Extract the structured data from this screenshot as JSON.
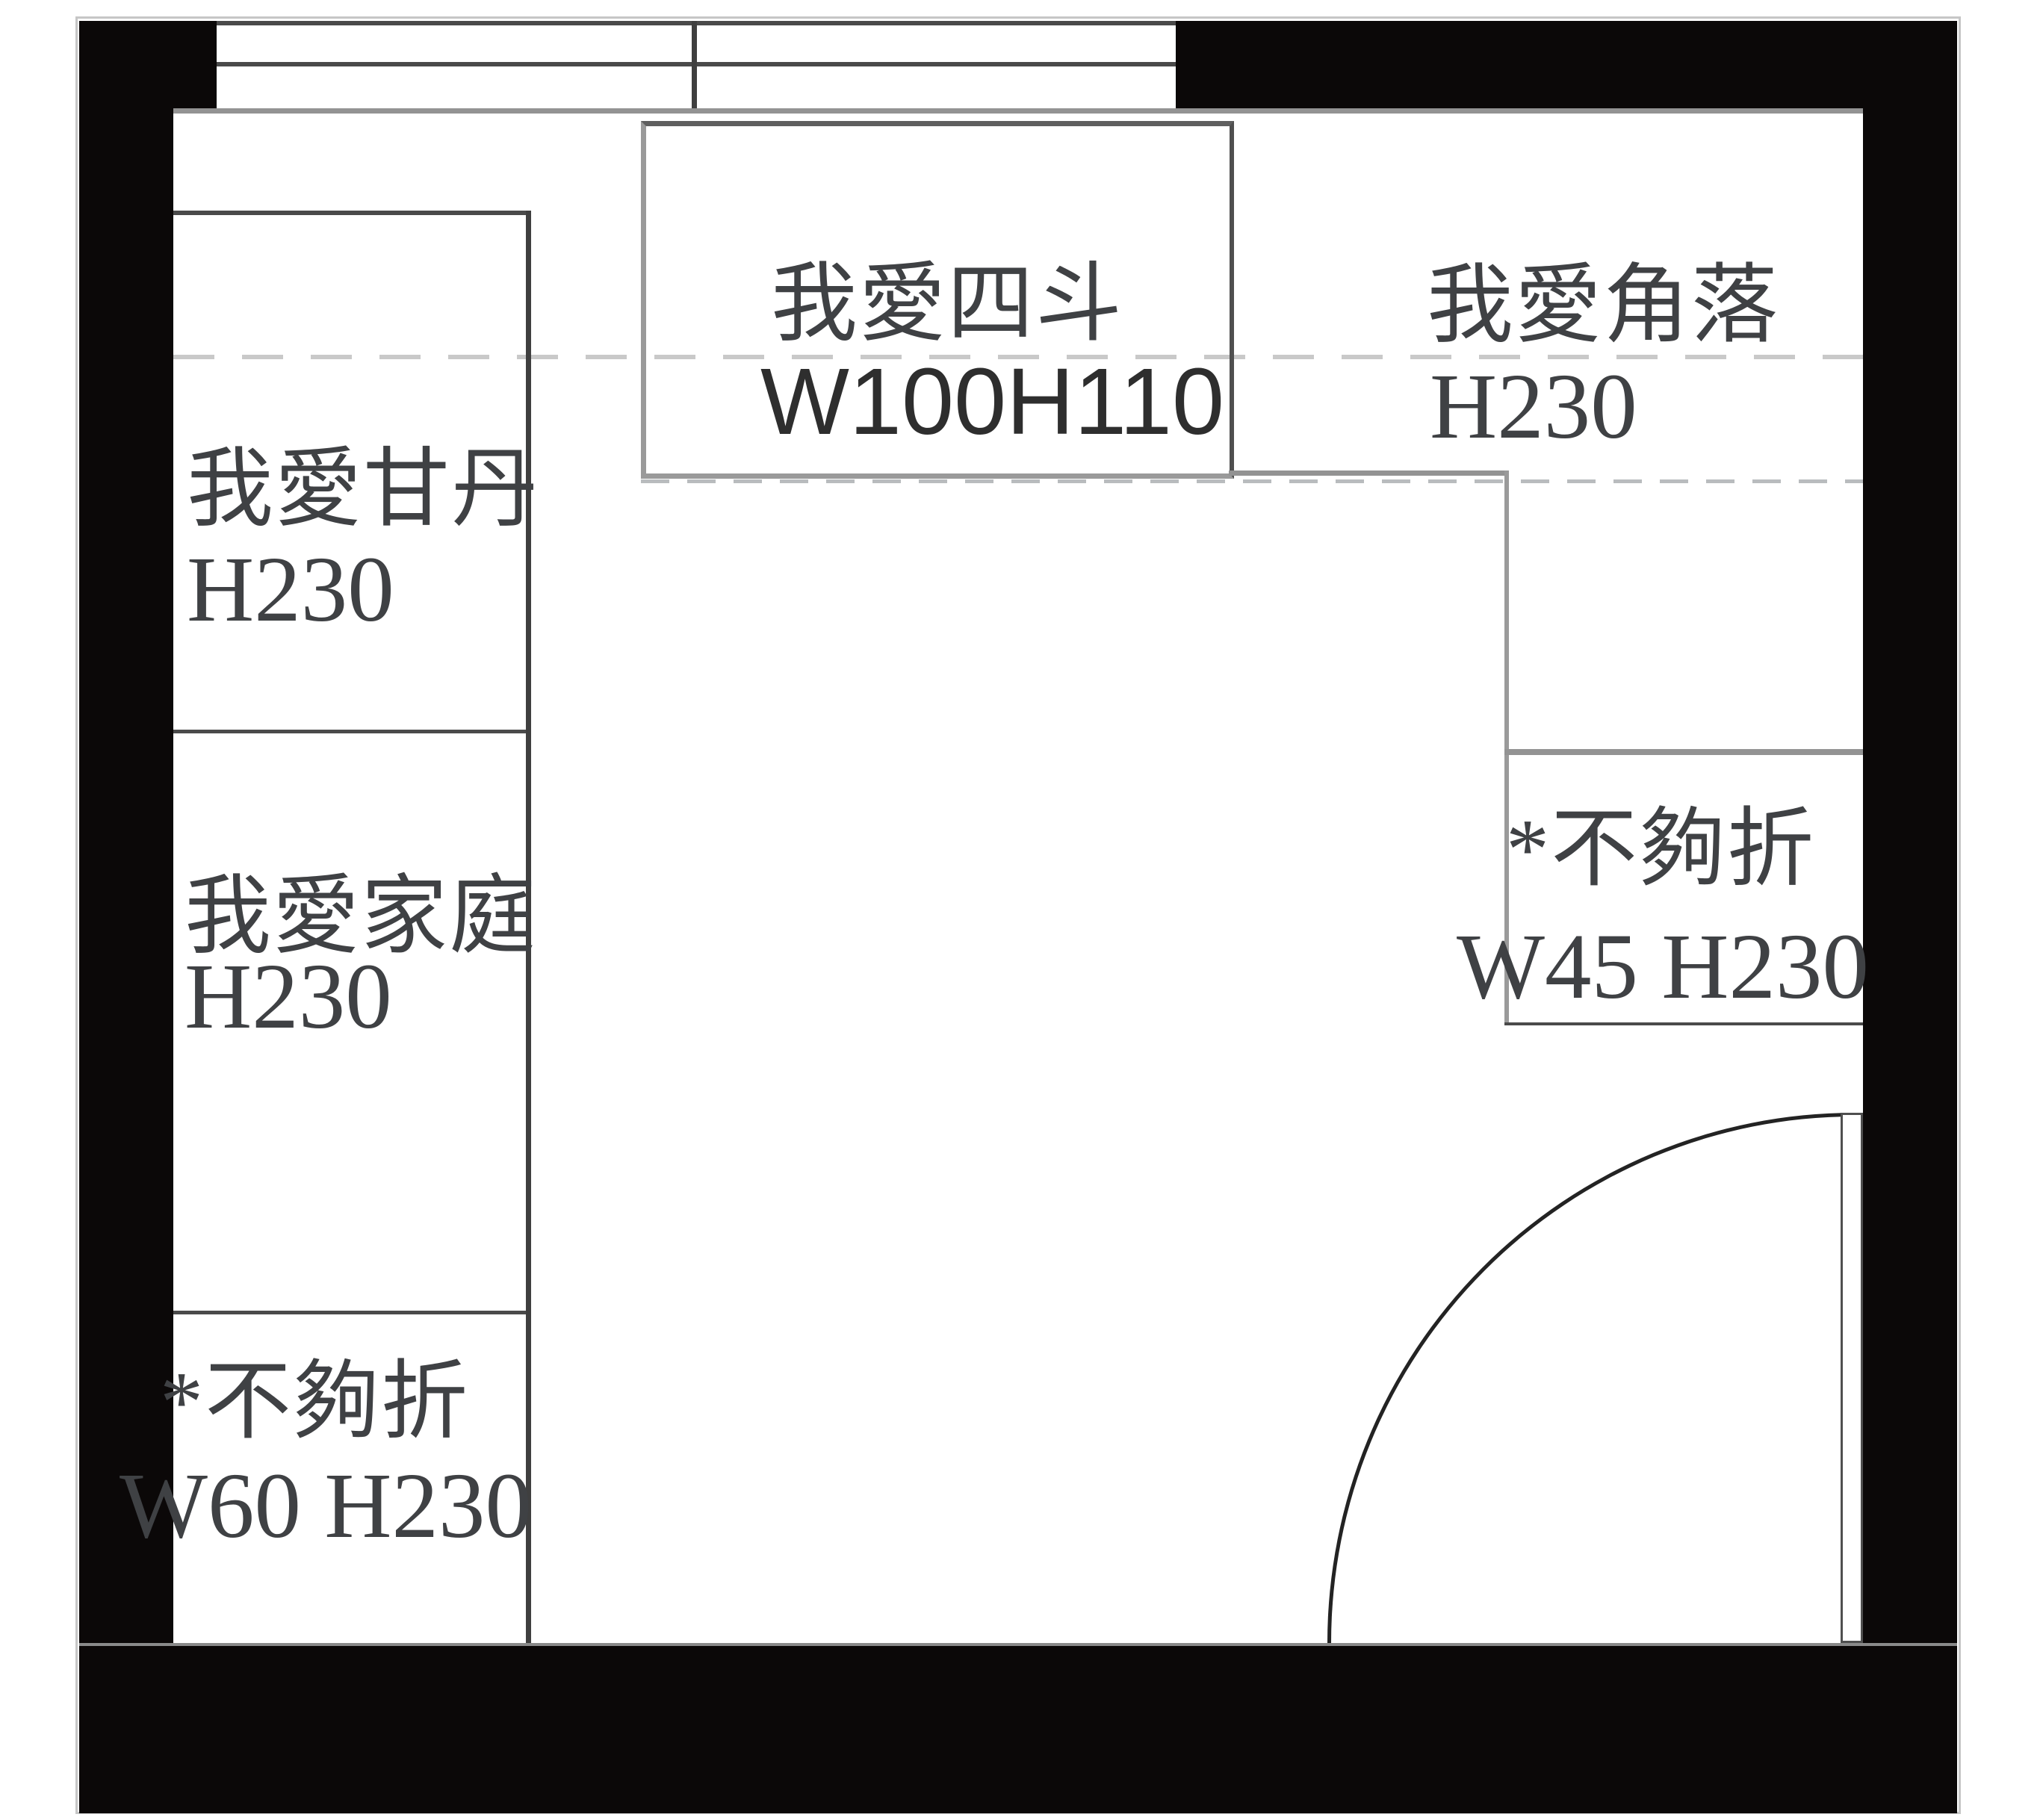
{
  "plan": {
    "type": "floor-plan",
    "colors": {
      "wall": "#0b0808",
      "line_dark": "#3f3f3f",
      "line_gray": "#9a9a9a",
      "dash_upper": "#c9c9c9",
      "dash_lower": "#b9bcbe",
      "text": "#3f4144"
    },
    "cabinets": [
      {
        "id": "left-top",
        "name": "我愛甘丹",
        "dims": "H230"
      },
      {
        "id": "left-middle",
        "name": "我愛家庭",
        "dims": "H230"
      },
      {
        "id": "left-bottom",
        "name": "*不夠折",
        "dims": "W60 H230"
      },
      {
        "id": "top-center",
        "name": "我愛四斗",
        "dims": "W100H110"
      },
      {
        "id": "top-right-corner",
        "name": "我愛角落",
        "dims": "H230"
      },
      {
        "id": "right-middle",
        "name": "*不夠折",
        "dims": "W45 H230"
      }
    ]
  }
}
